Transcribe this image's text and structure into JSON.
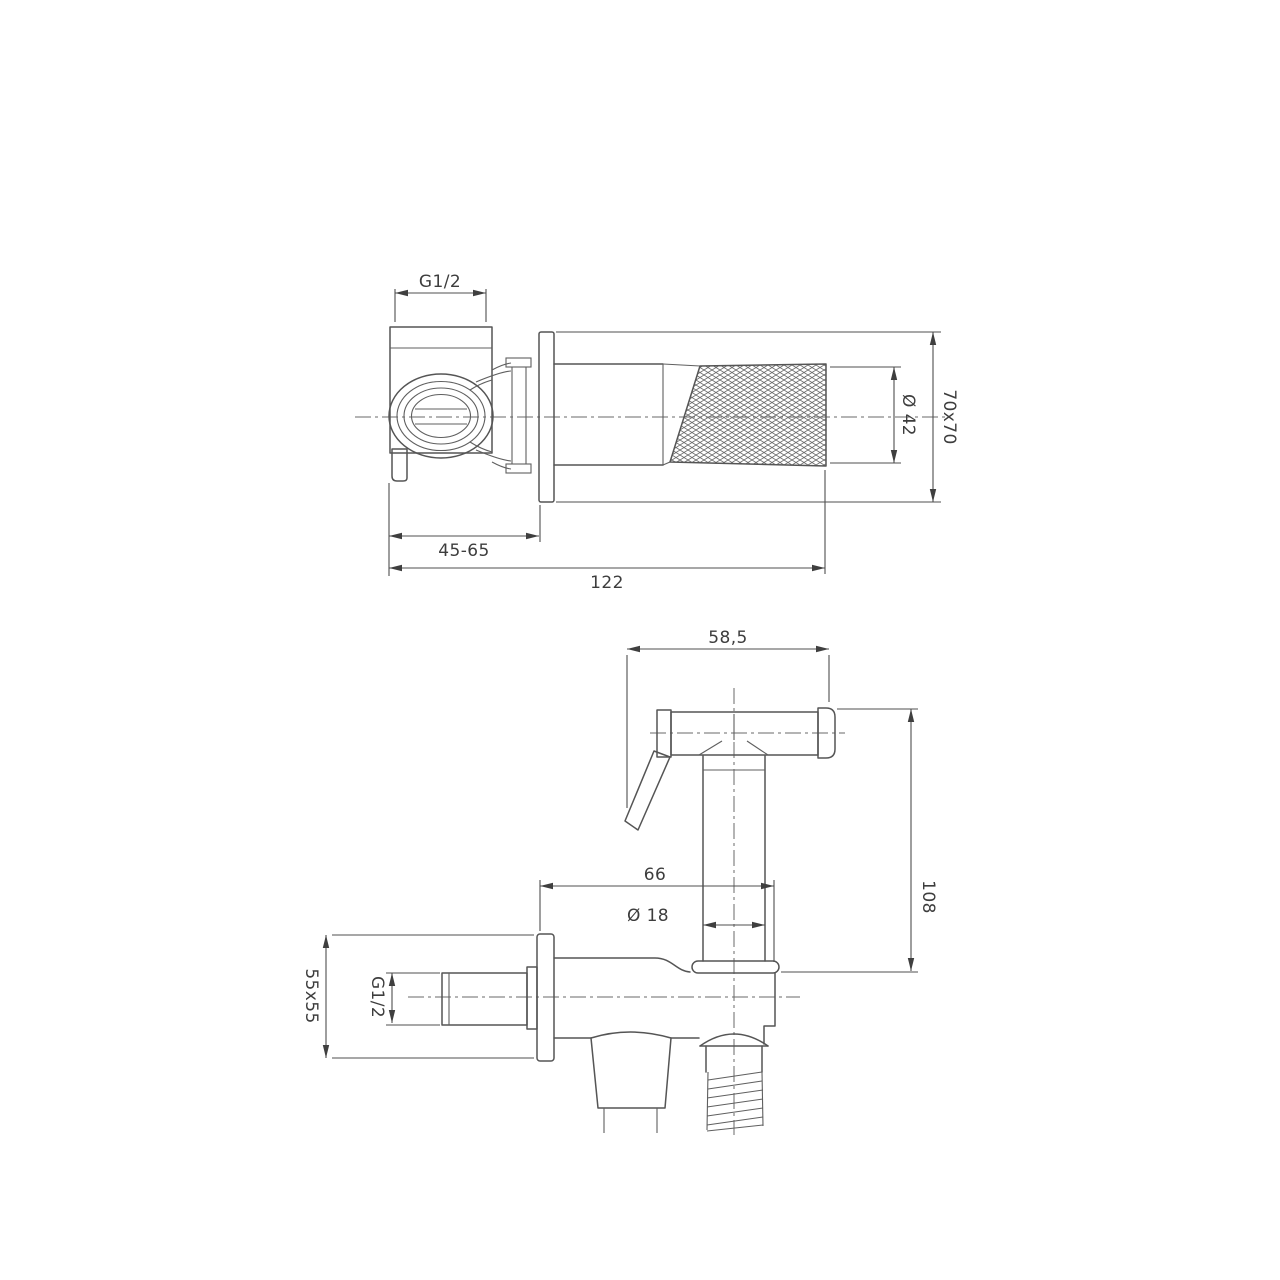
{
  "drawing": {
    "type": "technical-drawing",
    "subject": "wall-mounted bidet sprayer valve with hand shower",
    "background_color": "#ffffff",
    "line_color": "#555555",
    "views": {
      "top_view": {
        "name": "valve-side-view",
        "dimensions": {
          "inlet_thread": "G1/2",
          "depth_range": "45-65",
          "total_length": "122",
          "handle_diameter": "Ø 42",
          "flange_size": "70x70"
        }
      },
      "bottom_view": {
        "name": "sprayer-front-view",
        "dimensions": {
          "head_width": "58,5",
          "sprayer_height": "108",
          "body_offset": "66",
          "tube_diameter": "Ø 18",
          "outlet_thread": "G1/2",
          "plate_size": "55x55"
        }
      }
    }
  }
}
